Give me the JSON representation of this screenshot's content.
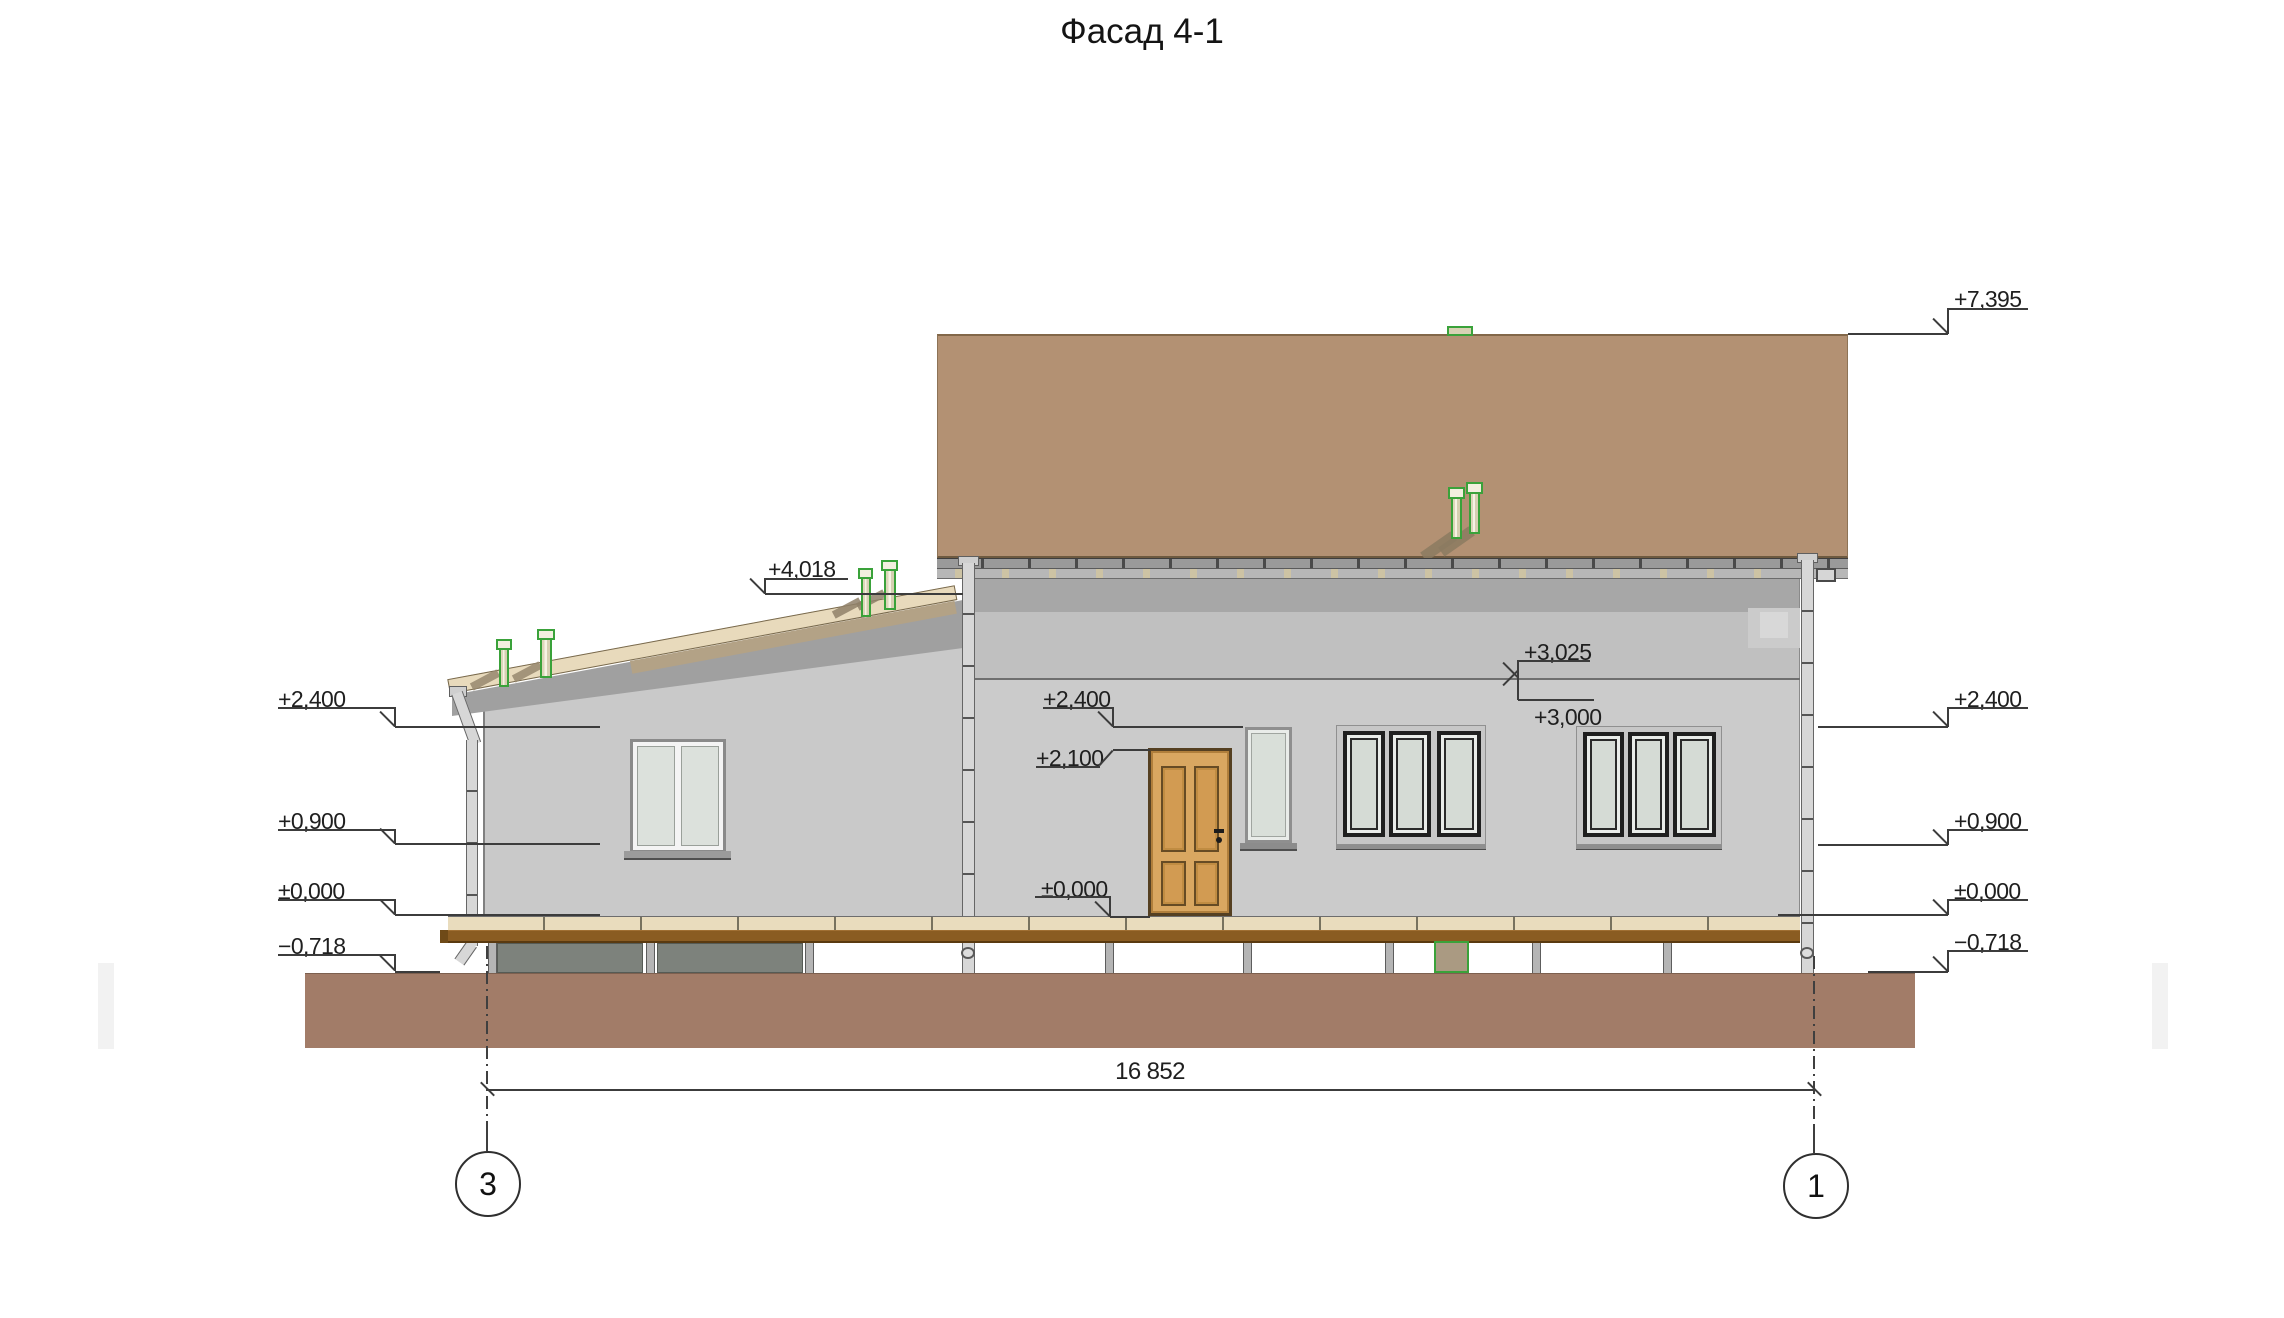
{
  "title": "Фасад 4-1",
  "marks": {
    "left": [
      {
        "label": "+2,400"
      },
      {
        "label": "+0,900"
      },
      {
        "label": "±0,000"
      },
      {
        "label": "−0,718"
      }
    ],
    "right": [
      {
        "label": "+7,395"
      },
      {
        "label": "+2,400"
      },
      {
        "label": "+0,900"
      },
      {
        "label": "±0,000"
      },
      {
        "label": "−0,718"
      }
    ],
    "middle": [
      {
        "label": "+2,400"
      },
      {
        "label": "+2,100"
      },
      {
        "label": "±0,000"
      }
    ],
    "annex_roof": {
      "label": "+4,018"
    },
    "attic_floor": {
      "upper": "+3,025",
      "lower": "+3,000"
    }
  },
  "dimension": {
    "total": "16 852"
  },
  "grid_axes": {
    "left": "3",
    "right": "1"
  },
  "colors": {
    "main_roof": "#b39173",
    "wall": "#cbcbcb",
    "door": "#d9a761",
    "roof_edge_band": "#e8dabc",
    "floor_deck": "#e9dcbd",
    "floor_joist": "#8a5c22",
    "ground": "#a27c68",
    "vent_green": "#3aa23a",
    "glass": "#d5dbd5"
  }
}
